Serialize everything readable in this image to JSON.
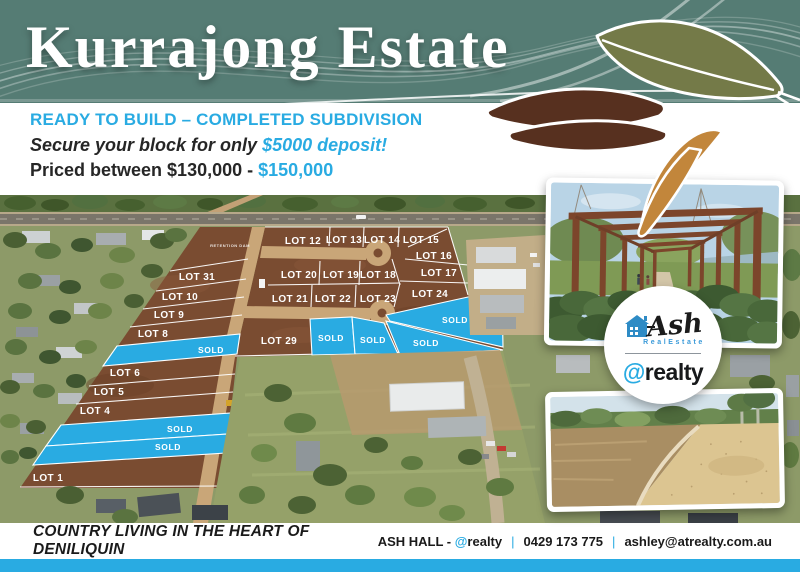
{
  "header": {
    "title": "Kurrajong Estate",
    "teal": "#557c74"
  },
  "intro": {
    "headline": "READY TO BUILD – COMPLETED SUBDIVISION",
    "secure_prefix": "Secure your block for only ",
    "secure_highlight": "$5000 deposit!",
    "price_prefix": "Priced between $130,000 - ",
    "price_highlight": "$150,000",
    "accent": "#29abe2"
  },
  "map": {
    "retention_label": "RETENTION DAM",
    "sold_label": "SOLD",
    "sold_color": "#29abe2",
    "lots": [
      {
        "label": "LOT 31"
      },
      {
        "label": "LOT 10"
      },
      {
        "label": "LOT 9"
      },
      {
        "label": "LOT 8"
      },
      {
        "label": "LOT 6"
      },
      {
        "label": "LOT 5"
      },
      {
        "label": "LOT 4"
      },
      {
        "label": "LOT 1"
      },
      {
        "label": "LOT 12"
      },
      {
        "label": "LOT 13"
      },
      {
        "label": "LOT 14"
      },
      {
        "label": "LOT 15"
      },
      {
        "label": "LOT 16"
      },
      {
        "label": "LOT 20"
      },
      {
        "label": "LOT 19"
      },
      {
        "label": "LOT 18"
      },
      {
        "label": "LOT 17"
      },
      {
        "label": "LOT 21"
      },
      {
        "label": "LOT 22"
      },
      {
        "label": "LOT 23"
      },
      {
        "label": "LOT 24"
      },
      {
        "label": "LOT 29"
      }
    ]
  },
  "logo": {
    "brand_script": "Ash",
    "brand_sub": "RealEstate",
    "at_symbol": "@",
    "brand_name": "realty"
  },
  "footer": {
    "tagline": "COUNTRY LIVING IN THE HEART OF DENILIQUIN",
    "agent_name": "ASH HALL - ",
    "agent_brand_at": "@",
    "agent_brand": "realty",
    "phone": "0429 173 775",
    "email": "ashley@atrealty.com.au",
    "separator": "|"
  }
}
